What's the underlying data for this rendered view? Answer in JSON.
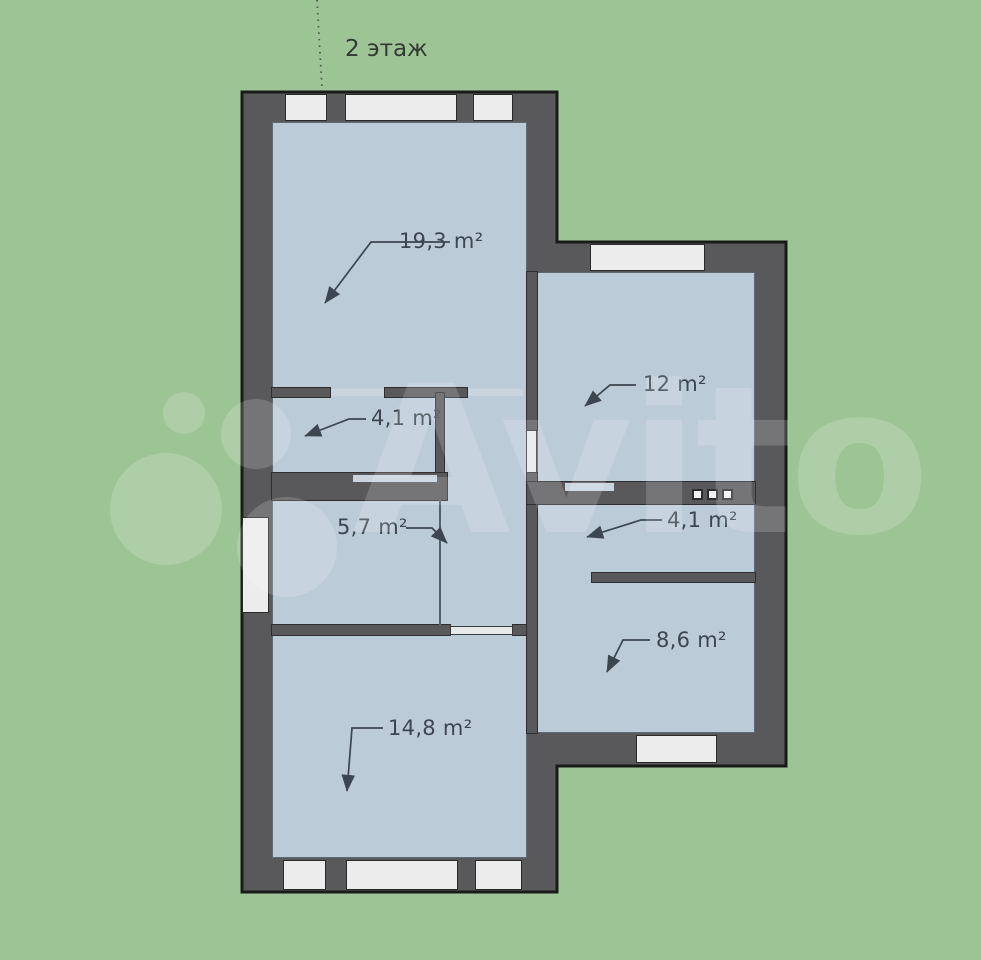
{
  "floor": {
    "label": "2 этаж"
  },
  "watermark": {
    "text": "Avito"
  },
  "rooms": [
    {
      "name": "room-19-3",
      "area": "19,3 m²"
    },
    {
      "name": "room-12",
      "area": "12 m²"
    },
    {
      "name": "room-4-1-left",
      "area": "4,1 m²"
    },
    {
      "name": "room-5-7",
      "area": "5,7 m²"
    },
    {
      "name": "room-4-1-right",
      "area": "4,1 m²"
    },
    {
      "name": "room-8-6",
      "area": "8,6 m²"
    },
    {
      "name": "room-14-8",
      "area": "14,8 m²"
    }
  ],
  "colors": {
    "background": "#9dc495",
    "wall": "#59595b",
    "outline": "#1a1a1a",
    "room_fill": "#bccbd8",
    "window_fill": "#ececec",
    "label_text": "#3b4650",
    "watermark": "#ffffff"
  }
}
